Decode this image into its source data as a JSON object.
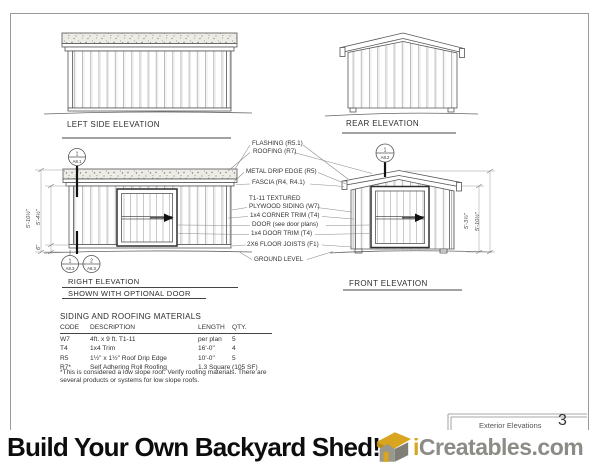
{
  "sheet": {
    "labels": {
      "left": "LEFT SIDE ELEVATION",
      "rear": "REAR ELEVATION",
      "right": "RIGHT ELEVATION",
      "right_sub": "SHOWN WITH OPTIONAL DOOR",
      "front": "FRONT ELEVATION"
    },
    "callouts": [
      "FLASHING (R5.1)",
      "ROOFING (R7)",
      "METAL DRIP EDGE (R5)",
      "FASCIA (R4, R4.1)",
      "T1-11 TEXTURED",
      "PLYWOOD SIDING (W7)",
      "1x4 CORNER TRIM (T4)",
      "DOOR (see door plans)",
      "1x4 DOOR TRIM (T4)",
      "2X6 FLOOR JOISTS (F1)",
      "GROUND LEVEL"
    ],
    "bubbles": {
      "right_top": {
        "num": "1",
        "ref": "A8.1"
      },
      "right_bottom_1": {
        "num": "1",
        "ref": "A8.3"
      },
      "right_bottom_2": {
        "num": "2",
        "ref": "A8.3"
      },
      "front_top": {
        "num": "1",
        "ref": "A8.2"
      }
    },
    "dims": {
      "right_total": "5'-10½\"",
      "right_wall": "5'-4½\"",
      "right_floor": "6\"",
      "front_eave": "5'-3¾\"",
      "front_peak": "5'-10½\""
    },
    "materials": {
      "title": "SIDING AND ROOFING MATERIALS",
      "headers": [
        "CODE",
        "DESCRIPTION",
        "LENGTH",
        "QTY."
      ],
      "rows": [
        [
          "W7",
          "4ft. x 9 ft. T1-11",
          "per plan",
          "5"
        ],
        [
          "T4",
          "1x4 Trim",
          "16'-0\"",
          "4"
        ],
        [
          "R5",
          "1½\" x 1½\" Roof Drip Edge",
          "10'-0\"",
          "5"
        ],
        [
          "R7*",
          "Self Adhering Roll Roofing",
          "1.3 Square",
          "(105 SF)"
        ]
      ],
      "note_line1": "*This is considered a low slope roof. Verify roofing materials. There are",
      "note_line2": "several products or systems for low slope roofs."
    },
    "titleblock": {
      "title": "Exterior Elevations",
      "number": "3"
    }
  },
  "banner": {
    "headline": "Build Your Own Backyard Shed!",
    "brand_prefix": "i",
    "brand_suffix": "Creatables.com",
    "colors": {
      "gold": "#D9A41F",
      "gray": "#8C8C86",
      "headline": "#0D0D0D"
    }
  }
}
